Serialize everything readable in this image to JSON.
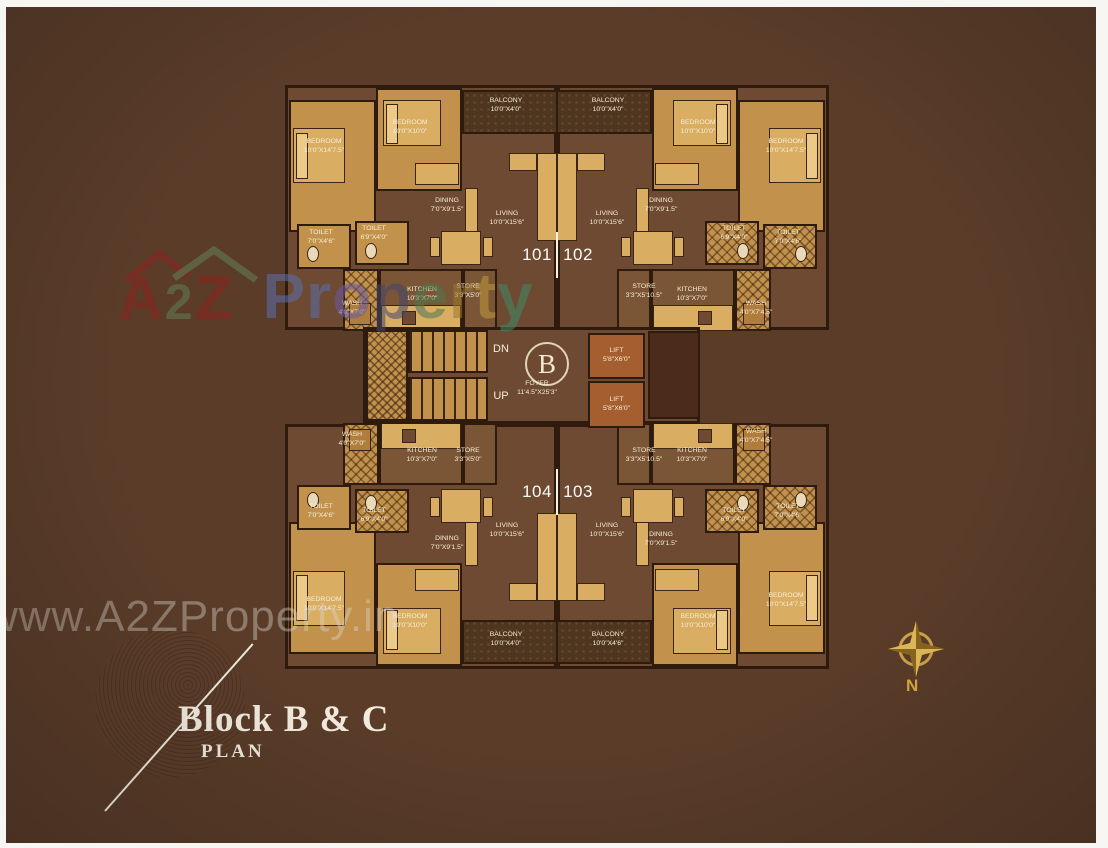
{
  "watermarks": {
    "site_url": "www.A2ZProperty.in",
    "logo": {
      "a2z_letters": [
        "A",
        "2",
        "Z"
      ],
      "property_letters": [
        "P",
        "r",
        "o",
        "p",
        "e",
        "r",
        "t",
        "y"
      ]
    }
  },
  "title_block": {
    "title": "Block B & C",
    "subtitle": "PLAN"
  },
  "compass": {
    "north_label": "N"
  },
  "core": {
    "unit_top_left": "101",
    "unit_top_right": "102",
    "unit_bottom_left": "104",
    "unit_bottom_right": "103",
    "stairs_down": "DN",
    "stairs_up": "UP",
    "block_letter": "B",
    "foyer_name": "FOYER",
    "foyer_dims": "11'4.5\"X25'3\"",
    "lift_upper_name": "LIFT",
    "lift_upper_dims": "5'8\"X6'0\"",
    "lift_lower_name": "LIFT",
    "lift_lower_dims": "5'8\"X6'0\""
  },
  "apartments": {
    "a101": {
      "bedroom1": {
        "name": "BEDROOM",
        "dims": "10'0\"X14'7.5\""
      },
      "bedroom2": {
        "name": "BEDROOM",
        "dims": "10'0\"X10'0\""
      },
      "balcony": {
        "name": "BALCONY",
        "dims": "10'0\"X4'0\""
      },
      "living": {
        "name": "LIVING",
        "dims": "10'0\"X15'6\""
      },
      "dining": {
        "name": "DINING",
        "dims": "7'0\"X9'1.5\""
      },
      "toilet1": {
        "name": "TOILET",
        "dims": "7'0\"X4'6\""
      },
      "toilet2": {
        "name": "TOILET",
        "dims": "6'9\"X4'0\""
      },
      "wash": {
        "name": "WASH",
        "dims": "4'0\"X7'0\""
      },
      "kitchen": {
        "name": "KITCHEN",
        "dims": "10'3\"X7'0\""
      },
      "store": {
        "name": "STORE",
        "dims": "3'3\"X5'0\""
      }
    },
    "a102": {
      "bedroom1": {
        "name": "BEDROOM",
        "dims": "10'0\"X14'7.5\""
      },
      "bedroom2": {
        "name": "BEDROOM",
        "dims": "10'0\"X10'0\""
      },
      "balcony": {
        "name": "BALCONY",
        "dims": "10'0\"X4'0\""
      },
      "living": {
        "name": "LIVING",
        "dims": "10'0\"X15'6\""
      },
      "dining": {
        "name": "DINING",
        "dims": "7'0\"X9'1.5\""
      },
      "toilet1": {
        "name": "TOILET",
        "dims": "7'0\"X4'6\""
      },
      "toilet2": {
        "name": "TOILET",
        "dims": "6'9\"X4'0\""
      },
      "wash": {
        "name": "WASH",
        "dims": "4'0\"X7'4.5\""
      },
      "kitchen": {
        "name": "KITCHEN",
        "dims": "10'3\"X7'0\""
      },
      "store": {
        "name": "STORE",
        "dims": "3'3\"X5'10.5\""
      }
    },
    "a104": {
      "bedroom1": {
        "name": "BEDROOM",
        "dims": "10'0\"X14'7.5\""
      },
      "bedroom2": {
        "name": "BEDROOM",
        "dims": "10'0\"X10'0\""
      },
      "balcony": {
        "name": "BALCONY",
        "dims": "10'0\"X4'0\""
      },
      "living": {
        "name": "LIVING",
        "dims": "10'0\"X15'6\""
      },
      "dining": {
        "name": "DINING",
        "dims": "7'0\"X9'1.5\""
      },
      "toilet1": {
        "name": "TOILET",
        "dims": "7'0\"X4'6\""
      },
      "toilet2": {
        "name": "TOILET",
        "dims": "6'9\"X4'0\""
      },
      "wash": {
        "name": "WASH",
        "dims": "4'0\"X7'0\""
      },
      "kitchen": {
        "name": "KITCHEN",
        "dims": "10'3\"X7'0\""
      },
      "store": {
        "name": "STORE",
        "dims": "3'3\"X5'0\""
      }
    },
    "a103": {
      "bedroom1": {
        "name": "BEDROOM",
        "dims": "10'0\"X14'7.5\""
      },
      "bedroom2": {
        "name": "BEDROOM",
        "dims": "10'0\"X10'0\""
      },
      "balcony": {
        "name": "BALCONY",
        "dims": "10'0\"X4'6\""
      },
      "living": {
        "name": "LIVING",
        "dims": "10'0\"X15'6\""
      },
      "dining": {
        "name": "DINING",
        "dims": "7'0\"X9'1.5\""
      },
      "toilet1": {
        "name": "TOILET",
        "dims": "7'0\"X4'6\""
      },
      "toilet2": {
        "name": "TOILET",
        "dims": "6'9\"X4'0\""
      },
      "wash": {
        "name": "WASH",
        "dims": "4'0\"X7'4.5\""
      },
      "kitchen": {
        "name": "KITCHEN",
        "dims": "10'3\"X7'0\""
      },
      "store": {
        "name": "STORE",
        "dims": "3'3\"X5'10.5\""
      }
    }
  }
}
